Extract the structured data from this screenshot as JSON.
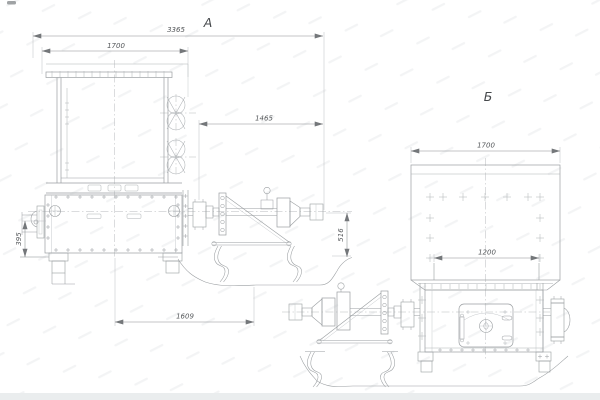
{
  "drawing": {
    "type": "engineering-two-view-assembly-drawing",
    "colors": {
      "background": "#ffffff",
      "line": "#9a9ea1",
      "dim_line": "#898c8f",
      "text": "#54575a",
      "footer_band": "#eaedee"
    },
    "view_a": {
      "label": "А",
      "dimensions": {
        "overall_length": "3365",
        "hopper_width": "1700",
        "drive_projection": "1465",
        "left_bracket_height": "395",
        "base_span": "1609",
        "drive_axis_height": "516"
      }
    },
    "view_b": {
      "label": "Б",
      "dimensions": {
        "hopper_width": "1700",
        "outlet_width": "1200"
      }
    }
  }
}
